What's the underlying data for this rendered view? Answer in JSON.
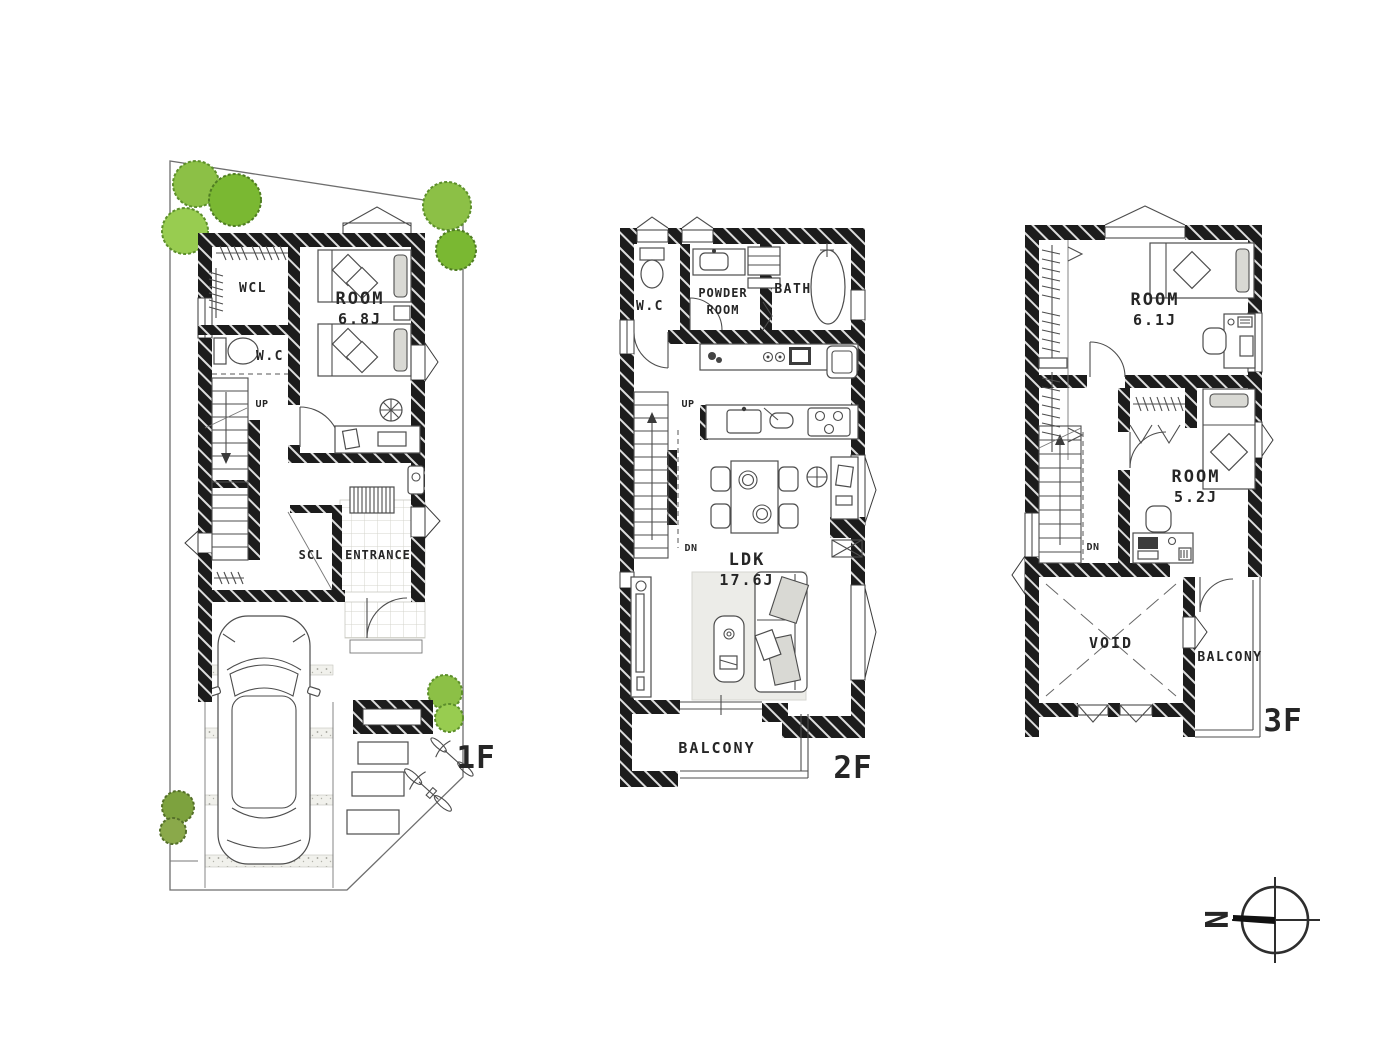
{
  "floors": {
    "f1": {
      "floor_label": "1F",
      "wcl": "WCL",
      "wc": "W.C",
      "room_name": "ROOM",
      "room_size": "6.8J",
      "up": "UP",
      "scl": "SCL",
      "entrance": "ENTRANCE"
    },
    "f2": {
      "floor_label": "2F",
      "wc": "W.C",
      "powder_line1": "POWDER",
      "powder_line2": "ROOM",
      "bath": "BATH",
      "up": "UP",
      "dn": "DN",
      "ldk_name": "LDK",
      "ldk_size": "17.6J",
      "balcony": "BALCONY"
    },
    "f3": {
      "floor_label": "3F",
      "room1_name": "ROOM",
      "room1_size": "6.1J",
      "room2_name": "ROOM",
      "room2_size": "5.2J",
      "dn": "DN",
      "void": "VOID",
      "balcony": "BALCONY"
    }
  },
  "compass": {
    "north": "N"
  },
  "palette": {
    "wall": "#1c1c1c",
    "tree_green": "#8cc046",
    "tree_edge": "#5d8f2b",
    "tree_olive": "#7da23e",
    "rug": "#ecece8",
    "cushion": "#d9d9d4"
  }
}
